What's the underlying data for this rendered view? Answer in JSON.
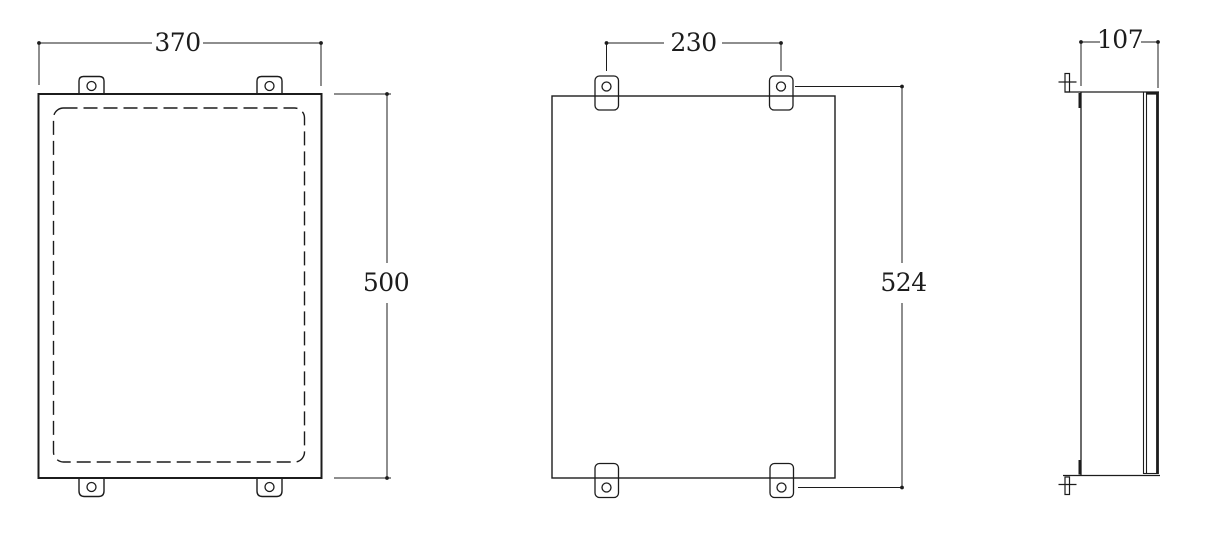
{
  "colors": {
    "background": "#ffffff",
    "line": "#1c1c1c"
  },
  "dimensions": {
    "front_width": "370",
    "front_height": "500",
    "back_hole_spacing_width": "230",
    "back_hole_spacing_height": "524",
    "side_depth": "107"
  }
}
